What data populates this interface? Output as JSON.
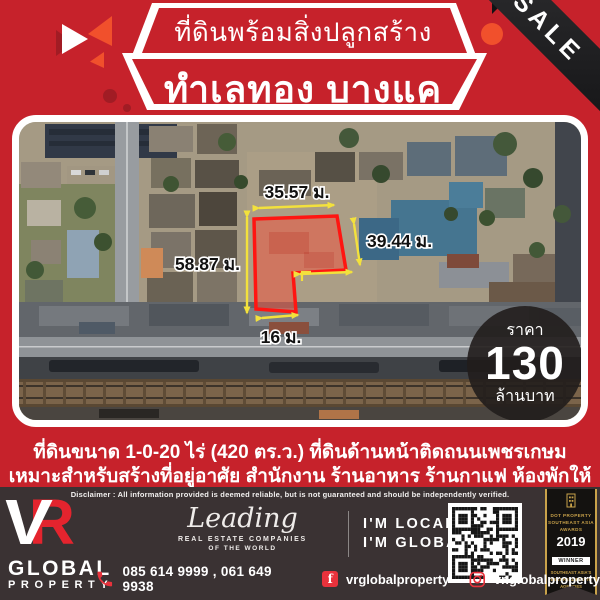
{
  "header": {
    "banner_top": "ที่ดินพร้อมสิ่งปลูกสร้าง",
    "banner_main": "ทำเลทอง บางแค",
    "sale": "SALE"
  },
  "map": {
    "dim_top": "35.57 ม.",
    "dim_right": "39.44 ม.",
    "dim_left": "58.87 ม.",
    "dim_bottom": "16 ม.",
    "price": {
      "label": "ราคา",
      "amount": "130",
      "unit": "ล้านบาท"
    }
  },
  "description": {
    "line1": "ที่ดินขนาด 1-0-20 ไร่ (420 ตร.ว.) ที่ดินด้านหน้าติดถนนเพชรเกษม",
    "line2": "เหมาะสำหรับสร้างที่อยู่อาศัย สำนักงาน ร้านอาหาร ร้านกาแฟ ห้องพักให้เช่า"
  },
  "footer": {
    "disclaimer": "Disclaimer :  All information provided is deemed reliable, but is not guaranteed and should be independently verified.",
    "logo": {
      "v": "V",
      "r": "R",
      "global": "GLOBAL",
      "property": "PROPERTY"
    },
    "leadingre": {
      "name": "Leading",
      "sub1": "REAL ESTATE COMPANIES",
      "sub2": "OF THE WORLD"
    },
    "tagline": {
      "line1": "I'M LOCAL",
      "line2": "I'M GLOBAL™"
    },
    "award": {
      "l1": "DOT PROPERTY",
      "l2": "SOUTHEAST ASIA",
      "l3": "AWARDS",
      "year": "2019",
      "winner": "WINNER",
      "l4": "SOUTHEAST ASIA'S",
      "l5": "BEST REAL ESTATE AGENCIES",
      "l6": "VR Global Property"
    },
    "contact": {
      "phones": "085 614 9999 , 061 649 9938",
      "facebook": "vrglobalproperty",
      "instagram": "vr.globalproperty"
    },
    "icons": {
      "facebook_glyph": "f"
    }
  },
  "colors": {
    "background_red": "#c6222b",
    "dark_red": "#a11c24",
    "accent_orange": "#f1502c",
    "footer_bg": "#3a3233",
    "brand_red": "#e4242e",
    "gold": "#c9a24a",
    "dimension_yellow": "#f3e13c",
    "plot_outline_red": "#ff1511",
    "ribbon_black": "#1d1d1f"
  }
}
